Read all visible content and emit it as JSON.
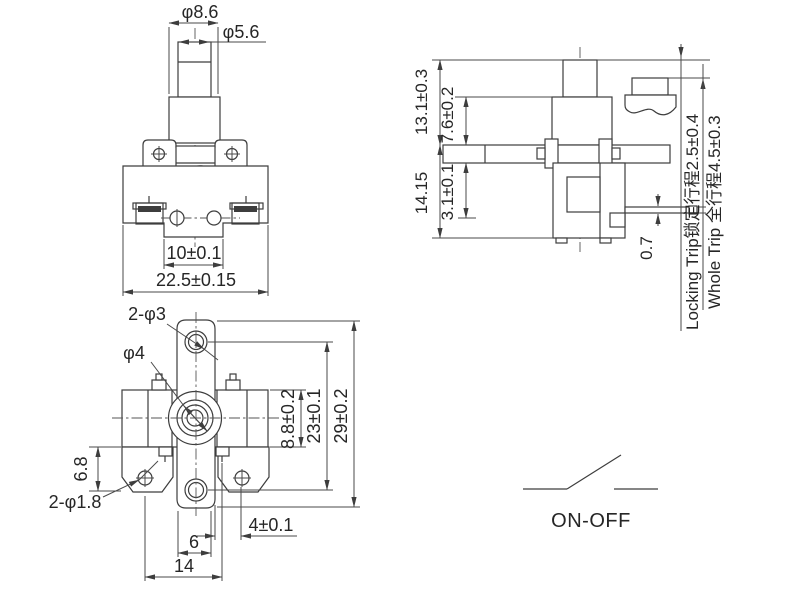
{
  "drawing_title": "Push button switch technical drawing",
  "front": {
    "phi86": "φ8.6",
    "phi56": "φ5.6",
    "d10": "10±0.1",
    "d225": "22.5±0.15"
  },
  "side": {
    "d131": "13.1±0.3",
    "d76": "7.6±0.2",
    "d1415": "14.15",
    "d31": "3.1±0.1",
    "d07": "0.7",
    "locking": "Locking Trip锁定行程2.5±0.4",
    "whole": "Whole Trip 全行程4.5±0.3"
  },
  "bottom": {
    "p3": "2-φ3",
    "p4": "φ4",
    "d88": "8.8±0.2",
    "d23": "23±0.1",
    "d29": "29±0.2",
    "d68": "6.8",
    "p18": "2-φ1.8",
    "d4": "4±0.1",
    "d6": "6",
    "d14": "14"
  },
  "circuit": {
    "label": "ON-OFF"
  },
  "colors": {
    "line": "#3d3d3d",
    "dim": "#4a4a4a",
    "text": "#262626",
    "background": "#ffffff"
  }
}
